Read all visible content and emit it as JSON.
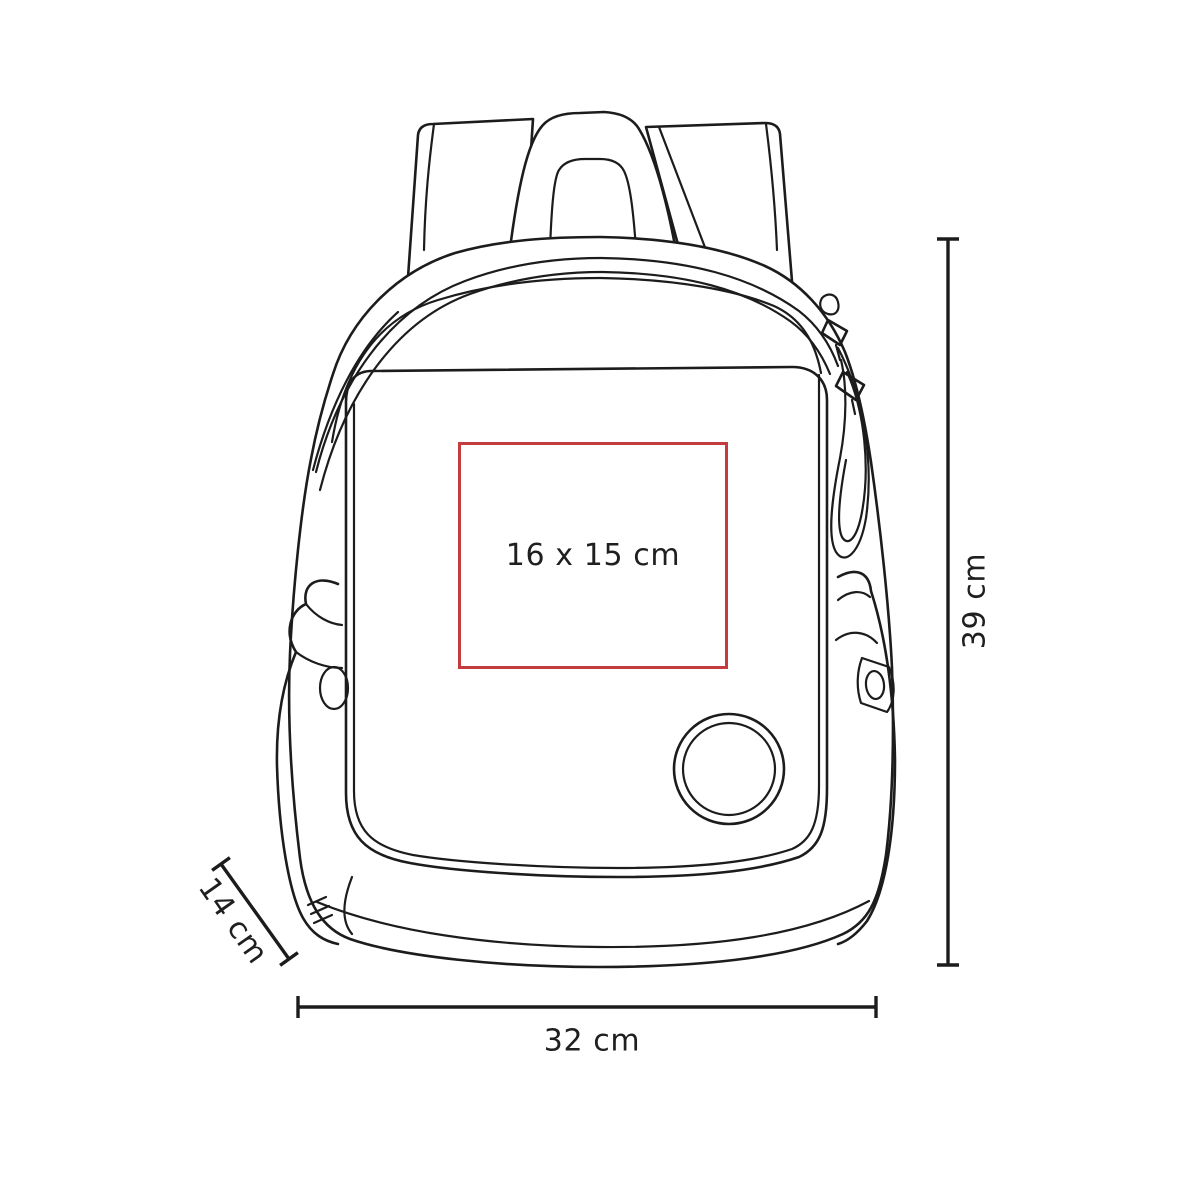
{
  "diagram": {
    "type": "product-dimension-diagram",
    "product": "backpack-line-drawing",
    "labels": {
      "print_area": "16 x 15 cm",
      "height": "39 cm",
      "width": "32 cm",
      "depth": "14 cm"
    },
    "colors": {
      "print_area_border": "#c43b40",
      "line": "#1c1c1c",
      "background": "#ffffff"
    }
  }
}
